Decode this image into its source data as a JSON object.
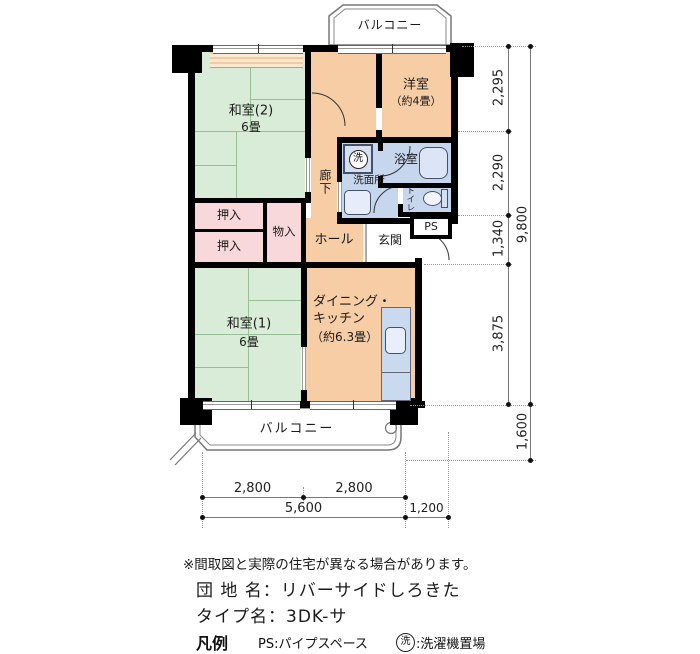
{
  "plan": {
    "balcony_top_label": "バルコニー",
    "balcony_bottom_label": "バルコニー",
    "rooms": {
      "western": {
        "name": "洋室",
        "size": "（約4畳）"
      },
      "washitsu2": {
        "name": "和室(2)",
        "size": "6畳"
      },
      "washitsu1": {
        "name": "和室(1)",
        "size": "6畳"
      },
      "dk": {
        "line1": "ダイニング・",
        "line2": "キッチン",
        "line3": "（約6.3畳）"
      },
      "corridor": "廊下",
      "washroom": "洗面所",
      "bathroom": "浴室",
      "toilet": "トイレ",
      "ps": "PS",
      "hall": "ホール",
      "entrance": "玄関",
      "closet_upper": "押入",
      "closet_lower": "押入",
      "storage": "物入",
      "laundry": "洗"
    },
    "colors": {
      "tatami": "#d9ecd7",
      "wood_floor": "#f6cda4",
      "wet_area": "#c6d6ec",
      "closet": "#f8d8da",
      "wall": "#000000"
    }
  },
  "dimensions": {
    "right_segments": [
      "2,295",
      "2,290",
      "1,340",
      "3,875"
    ],
    "right_total": "9,800",
    "right_balcony": "1,600",
    "bottom_segments": [
      "2,800",
      "2,800"
    ],
    "bottom_total": "5,600",
    "bottom_entrance": "1,200"
  },
  "footer": {
    "note": "※間取図と実際の住宅が異なる場合があります。",
    "estate_name": "団 地 名：リバーサイドしろきた",
    "type_name": "タイプ名：3DK-サ",
    "legend_title": "凡例",
    "legend_ps": "PS:パイプスペース",
    "legend_laundry_mark": "洗",
    "legend_laundry": ":洗濯機置場"
  }
}
